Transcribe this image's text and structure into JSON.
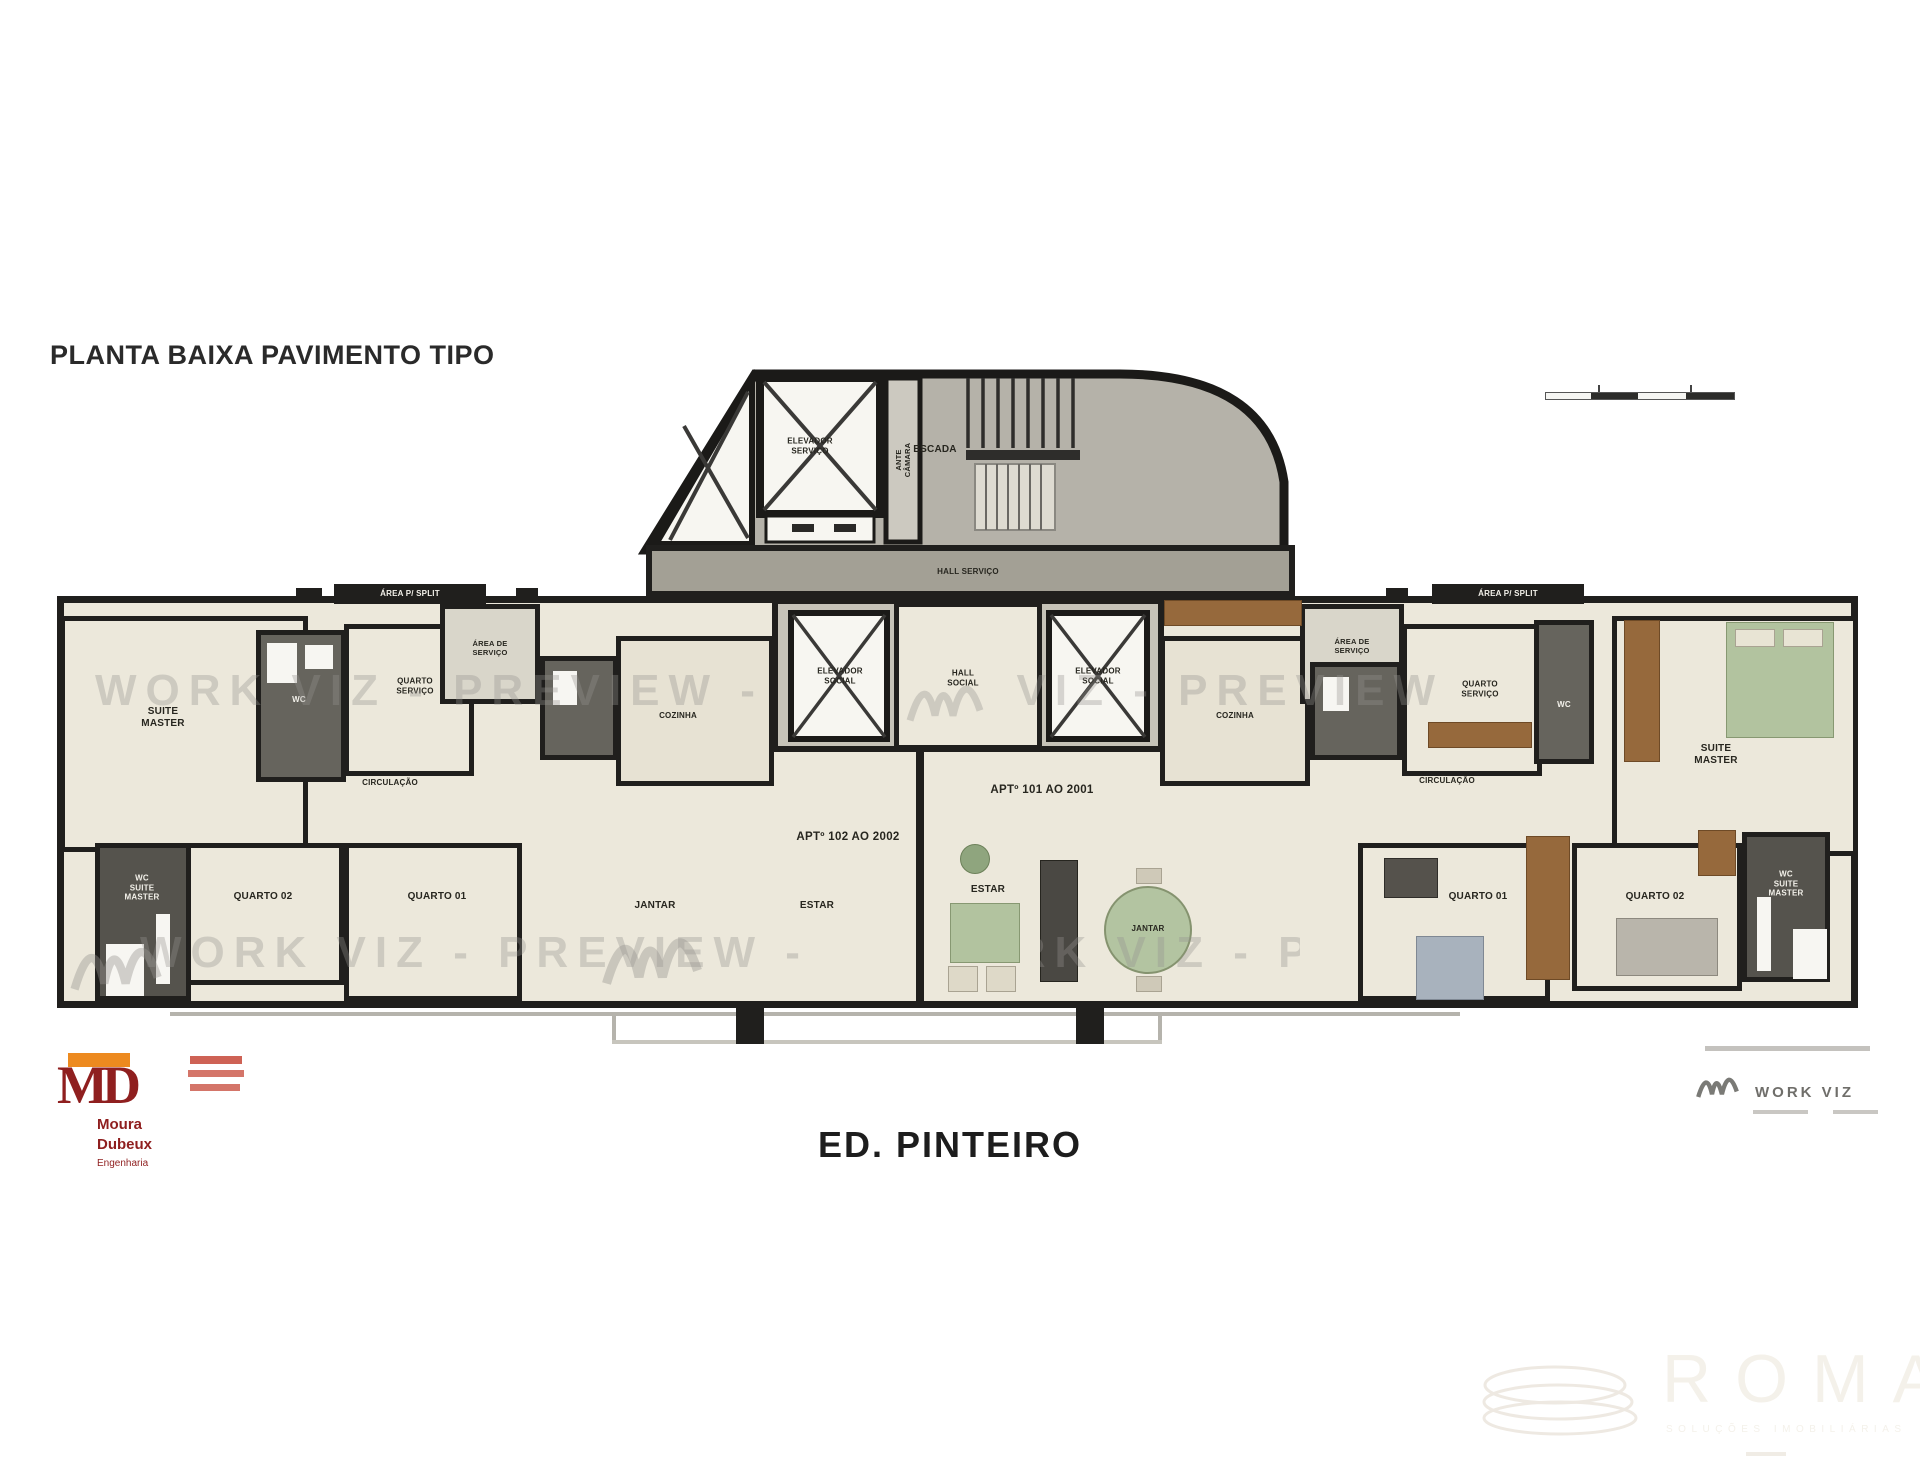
{
  "page": {
    "title": "PLANTA BAIXA PAVIMENTO TIPO",
    "building_name": "ED. PINTEIRO"
  },
  "watermark": {
    "text": "WORK VIZ - PREVIEW -"
  },
  "core": {
    "elevador_servico": "ELEVADOR\nSERVIÇO",
    "ante_camara": "ANTE\nCÂMARA",
    "escada": "ESCADA",
    "hall_servico": "HALL SERVIÇO",
    "elevador_social_left": "ELEVADOR\nSOCIAL",
    "hall_social": "HALL\nSOCIAL",
    "elevador_social_right": "ELEVADOR\nSOCIAL"
  },
  "apt_102": {
    "unit_label": "APTº 102 AO 2002",
    "suite_master": "SUITE\nMASTER",
    "wc_suite": "WC",
    "area_split": "ÁREA P/ SPLIT",
    "quarto_servico": "QUARTO\nSERVIÇO",
    "area_servico": "ÁREA DE\nSERVIÇO",
    "cozinha": "COZINHA",
    "circulacao": "CIRCULAÇÃO",
    "wc_suite_master": "WC\nSUITE\nMASTER",
    "quarto_02": "QUARTO 02",
    "quarto_01": "QUARTO 01",
    "jantar": "JANTAR",
    "estar": "ESTAR"
  },
  "apt_101": {
    "unit_label": "APTº 101 AO 2001",
    "estar": "ESTAR",
    "jantar": "JANTAR",
    "cozinha": "COZINHA",
    "area_servico": "ÁREA DE\nSERVIÇO",
    "area_split": "ÁREA P/ SPLIT",
    "quarto_servico": "QUARTO\nSERVIÇO",
    "wc": "WC",
    "circulacao": "CIRCULAÇÃO",
    "quarto_01": "QUARTO 01",
    "quarto_02": "QUARTO 02",
    "wc_suite_master": "WC\nSUITE\nMASTER",
    "suite_master": "SUITE\nMASTER"
  },
  "logos": {
    "md": {
      "monogram": "MD",
      "name_line1": "Moura",
      "name_line2": "Dubeux",
      "name_line3": "Engenharia"
    },
    "workviz": {
      "name": "WORK VIZ"
    },
    "roma": {
      "name": "ROMA",
      "tagline": "SOLUÇÕES IMOBILIÁRIAS"
    }
  },
  "colors": {
    "wall": "#201f1d",
    "room_fill": "#ece8db",
    "service_fill": "#c6c3b8",
    "furniture_green": "#b2c39f",
    "wood": "#96693c",
    "logo_red": "#8f1f1f",
    "logo_orange": "#ed8a1f"
  }
}
